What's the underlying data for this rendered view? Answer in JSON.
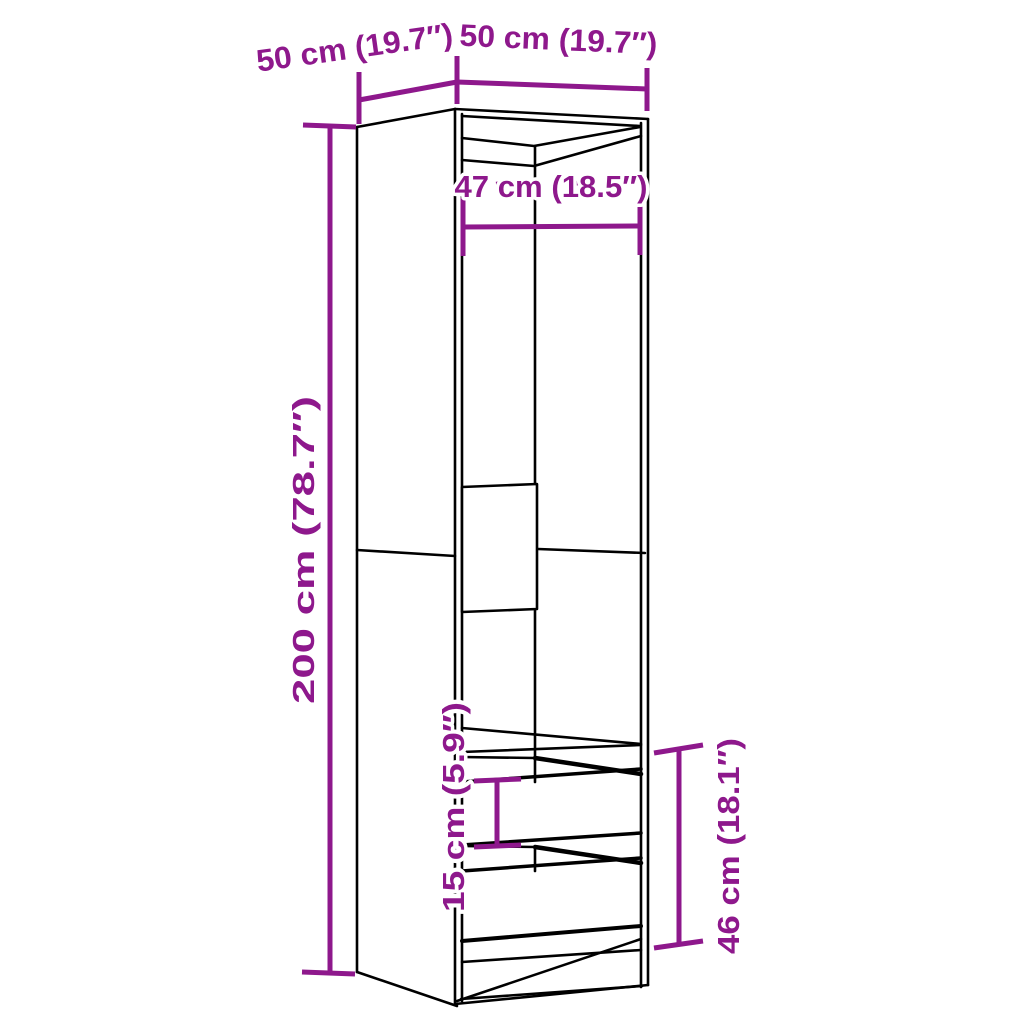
{
  "diagram": {
    "kind": "furniture-dimension-diagram",
    "subject": "tall wardrobe with two drawers, open front, perspective line drawing",
    "colors": {
      "background": "#ffffff",
      "outline": "#000000",
      "dimension": "#8E188C"
    },
    "labels": {
      "depth_top_left": "50 cm (19.7″)",
      "width_top_right": "50 cm (19.7″)",
      "inner_width": "47 cm (18.5″)",
      "total_height": "200 cm (78.7″)",
      "drawer_front_height": "15 cm (5.9″)",
      "drawer_section_height": "46 cm (18.1″)"
    }
  }
}
